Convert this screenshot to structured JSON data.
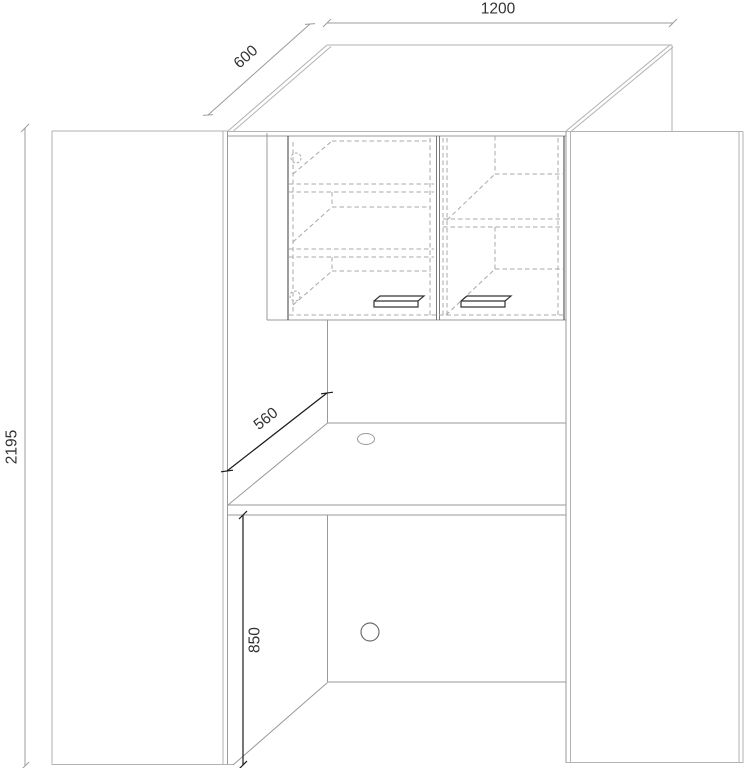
{
  "title": "cabinet-desk-technical-drawing",
  "dimensions": {
    "width": "1200",
    "depth": "600",
    "height": "2195",
    "desk_depth": "560",
    "worktop_height": "850"
  },
  "colors": {
    "background": "#ffffff",
    "object_line": "#b2b2b2",
    "door_edge": "#4d4d4d",
    "hidden_line": "#a8a8a8",
    "dimension_light": "#9c9c9c",
    "dimension_dark": "#1a1a1a",
    "text": "#333333"
  }
}
